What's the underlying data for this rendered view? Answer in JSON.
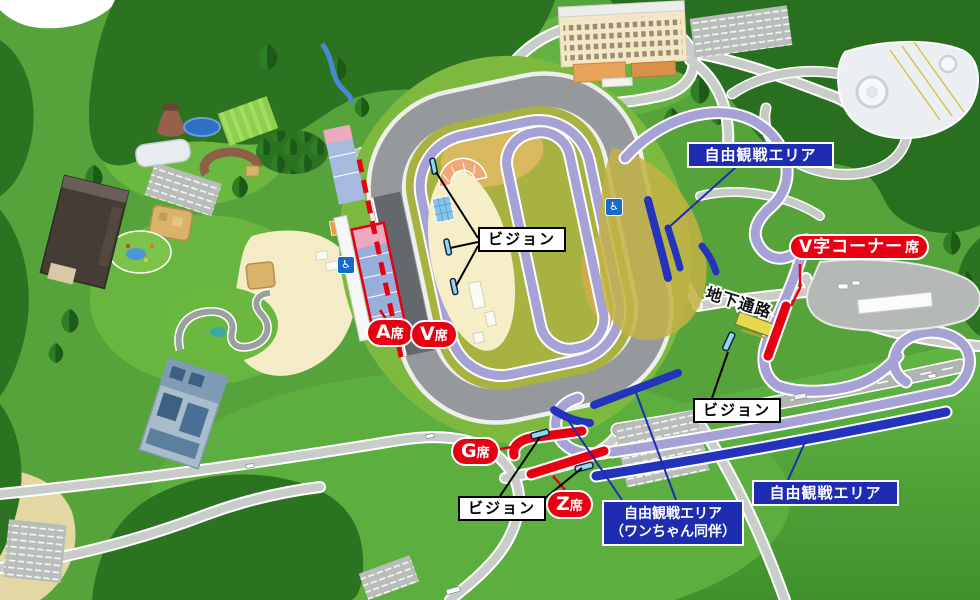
{
  "map_labels": {
    "free_viewing_area": "自由観戦エリア",
    "free_viewing_area_dog_line1": "自由観戦エリア",
    "free_viewing_area_dog_line2": "（ワンちゃん同伴）",
    "v_corner_name": "V字コーナー",
    "seat_suffix": "席",
    "underground_passage": "地下通路",
    "vision": "ビジョン",
    "seat_a": "A",
    "seat_v": "V",
    "seat_g": "G",
    "seat_z": "Z"
  },
  "icons": {
    "wheelchair": "♿"
  },
  "colors": {
    "label_blue": "#1e2cb2",
    "seat_red": "#e60012",
    "vision_screen_cyan": "#8fd8f2",
    "free_viewing_strip_blue": "#2433bb",
    "track_lavender": "#a7a2d6",
    "oval_gray": "#95999c",
    "underground_yellow": "#e9d84e"
  }
}
